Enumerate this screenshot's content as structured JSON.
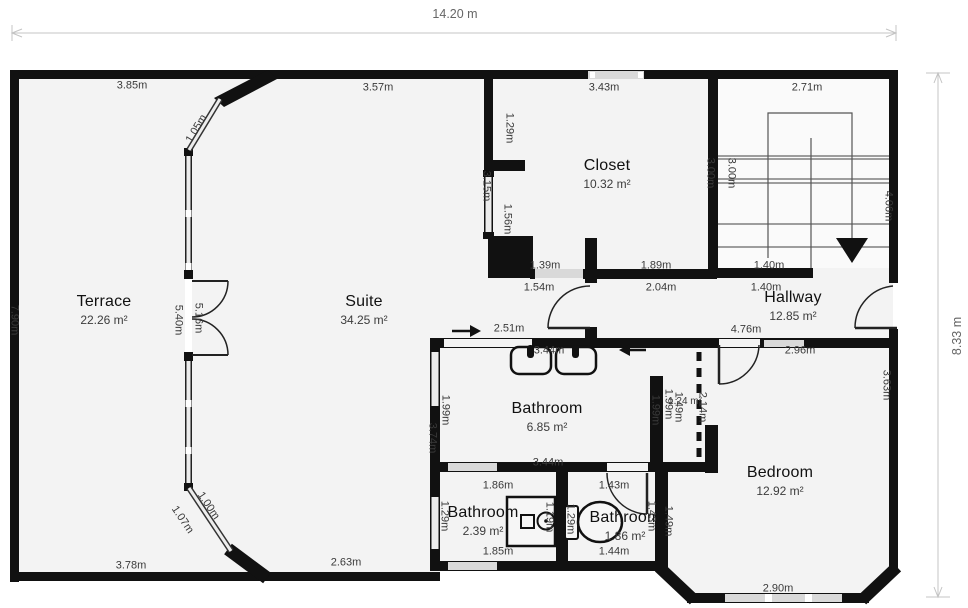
{
  "colors": {
    "wall": "#111111",
    "floor": "#f3f3f3",
    "window": "#d9d9d9",
    "dim_line": "#c4c4c4",
    "dim_text": "#3a3a3a"
  },
  "overall": {
    "width_label": "14.20 m",
    "height_label": "8.33 m"
  },
  "rooms": [
    {
      "name": "Terrace",
      "area": "22.26 m²",
      "x": 104,
      "y": 310
    },
    {
      "name": "Suite",
      "area": "34.25 m²",
      "x": 364,
      "y": 310
    },
    {
      "name": "Closet",
      "area": "10.32 m²",
      "x": 607,
      "y": 174
    },
    {
      "name": "Hallway",
      "area": "12.85 m²",
      "x": 793,
      "y": 306
    },
    {
      "name": "Bathroom",
      "area": "6.85 m²",
      "x": 547,
      "y": 417
    },
    {
      "name": "Bathroom",
      "area": "2.39 m²",
      "x": 483,
      "y": 521
    },
    {
      "name": "Bathroom",
      "area": "1.86 m²",
      "x": 625,
      "y": 526
    },
    {
      "name": "Bedroom",
      "area": "12.92 m²",
      "x": 780,
      "y": 481
    }
  ],
  "dims": [
    {
      "text": "14.20 m",
      "x": 455,
      "y": 14,
      "rot": 0,
      "cls": "xl"
    },
    {
      "text": "8.33 m",
      "x": 957,
      "y": 336,
      "rot": -90,
      "cls": "xl"
    },
    {
      "text": "3.85m",
      "x": 132,
      "y": 86,
      "rot": 0
    },
    {
      "text": "3.57m",
      "x": 378,
      "y": 88,
      "rot": 0
    },
    {
      "text": "3.43m",
      "x": 604,
      "y": 88,
      "rot": 0
    },
    {
      "text": "2.71m",
      "x": 807,
      "y": 88,
      "rot": 0
    },
    {
      "text": "1.05m",
      "x": 197,
      "y": 129,
      "rot": -59
    },
    {
      "text": "1.29m",
      "x": 509,
      "y": 128,
      "rot": 90
    },
    {
      "text": "3.15m",
      "x": 486,
      "y": 186,
      "rot": 90
    },
    {
      "text": "1.56m",
      "x": 507,
      "y": 219,
      "rot": 90
    },
    {
      "text": "3.00m",
      "x": 710,
      "y": 173,
      "rot": 90
    },
    {
      "text": "3.00m",
      "x": 731,
      "y": 173,
      "rot": 90
    },
    {
      "text": "4.06m",
      "x": 888,
      "y": 206,
      "rot": 90
    },
    {
      "text": "1.39m",
      "x": 545,
      "y": 266,
      "rot": 0
    },
    {
      "text": "1.89m",
      "x": 656,
      "y": 266,
      "rot": 0
    },
    {
      "text": "1.40m",
      "x": 769,
      "y": 266,
      "rot": 0
    },
    {
      "text": "1.54m",
      "x": 539,
      "y": 288,
      "rot": 0
    },
    {
      "text": "2.04m",
      "x": 661,
      "y": 288,
      "rot": 0
    },
    {
      "text": "1.40m",
      "x": 766,
      "y": 288,
      "rot": 0
    },
    {
      "text": "7.90m",
      "x": 14,
      "y": 320,
      "rot": 90
    },
    {
      "text": "5.40m",
      "x": 178,
      "y": 320,
      "rot": 90
    },
    {
      "text": "5.16m",
      "x": 198,
      "y": 318,
      "rot": 90
    },
    {
      "text": "2.51m",
      "x": 509,
      "y": 329,
      "rot": 0
    },
    {
      "text": "3.44m",
      "x": 549,
      "y": 351,
      "rot": 0
    },
    {
      "text": "4.76m",
      "x": 746,
      "y": 330,
      "rot": 0
    },
    {
      "text": "2.96m",
      "x": 800,
      "y": 351,
      "rot": 0
    },
    {
      "text": "1.99m",
      "x": 445,
      "y": 410,
      "rot": 90
    },
    {
      "text": "1.99m",
      "x": 655,
      "y": 410,
      "rot": 90
    },
    {
      "text": "3.74m",
      "x": 432,
      "y": 438,
      "rot": 90
    },
    {
      "text": "1.99m",
      "x": 668,
      "y": 404,
      "rot": 90
    },
    {
      "text": "1.49m",
      "x": 678,
      "y": 407,
      "rot": 90
    },
    {
      "text": "1.24 m²",
      "x": 685,
      "y": 402,
      "rot": 0,
      "cls": "small"
    },
    {
      "text": "2.14m",
      "x": 702,
      "y": 407,
      "rot": 90
    },
    {
      "text": "3.63m",
      "x": 886,
      "y": 385,
      "rot": 90
    },
    {
      "text": "3.44m",
      "x": 548,
      "y": 463,
      "rot": 0
    },
    {
      "text": "1.86m",
      "x": 498,
      "y": 486,
      "rot": 0
    },
    {
      "text": "1.43m",
      "x": 614,
      "y": 486,
      "rot": 0
    },
    {
      "text": "1.29m",
      "x": 444,
      "y": 516,
      "rot": 90
    },
    {
      "text": "1.19m",
      "x": 549,
      "y": 517,
      "rot": 90
    },
    {
      "text": "1.29m",
      "x": 570,
      "y": 519,
      "rot": 90
    },
    {
      "text": "1.43m",
      "x": 651,
      "y": 516,
      "rot": 90
    },
    {
      "text": "1.49m",
      "x": 668,
      "y": 521,
      "rot": 90
    },
    {
      "text": "1.07m",
      "x": 182,
      "y": 520,
      "rot": 56
    },
    {
      "text": "1.00m",
      "x": 208,
      "y": 506,
      "rot": 56
    },
    {
      "text": "1.85m",
      "x": 498,
      "y": 552,
      "rot": 0
    },
    {
      "text": "1.44m",
      "x": 614,
      "y": 552,
      "rot": 0
    },
    {
      "text": "2.63m",
      "x": 346,
      "y": 563,
      "rot": 0
    },
    {
      "text": "3.78m",
      "x": 131,
      "y": 566,
      "rot": 0
    },
    {
      "text": "2.90m",
      "x": 778,
      "y": 589,
      "rot": 0
    }
  ]
}
